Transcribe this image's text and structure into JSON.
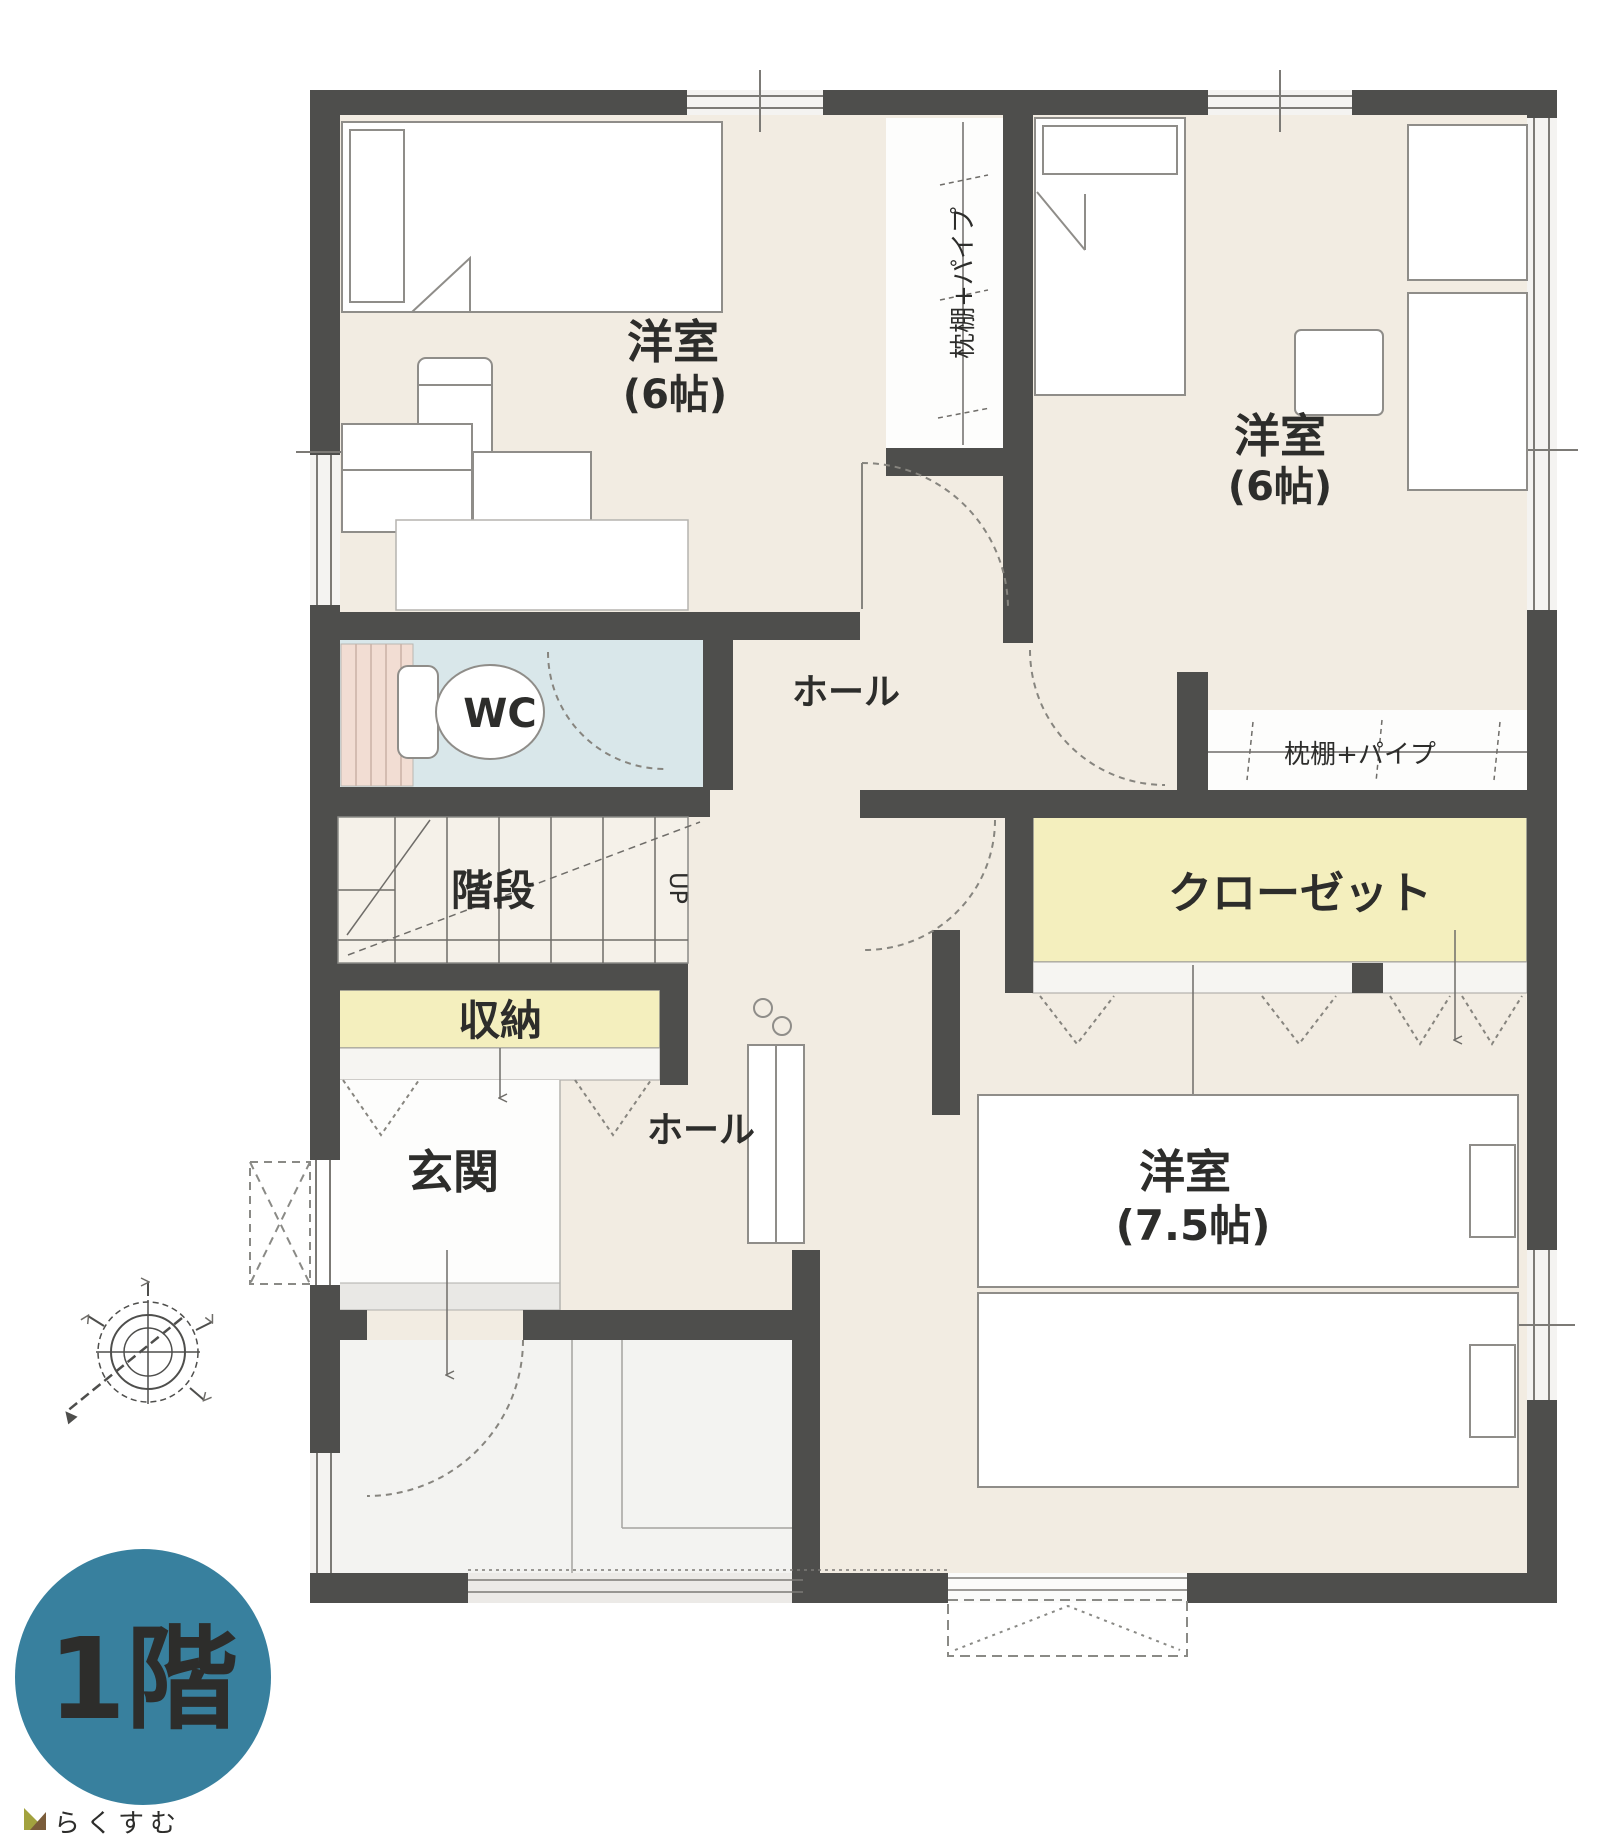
{
  "plan": {
    "floor_badge": "1階",
    "brand": "らくすむ",
    "labels": {
      "bedroom_nw": {
        "name": "洋室",
        "size": "(6帖)"
      },
      "bedroom_ne": {
        "name": "洋室",
        "size": "(6帖)"
      },
      "bedroom_s": {
        "name": "洋室",
        "size": "(7.5帖)"
      },
      "wc": "WC",
      "stairs": "階段",
      "stairs_direction": "UP",
      "storage": "収納",
      "entrance": "玄関",
      "hall_upper": "ホール",
      "hall_lower": "ホール",
      "closet": "クローゼット",
      "pillow_shelf_vertical": "枕棚+パイプ",
      "pillow_shelf_horizontal": "枕棚+パイプ"
    },
    "colors": {
      "wall": "#4e4e4c",
      "floor_beige": "#f2ece2",
      "floor_white": "#fdfdfc",
      "floor_gray": "#f3f3f1",
      "wc_blue": "#d9e7ea",
      "pink": "#f2ddd3",
      "yellow": "#f4efbe",
      "badge_teal": "#38809e",
      "line_gray": "#8a8a86",
      "text_dark": "#2d2d2b",
      "brand_brown": "#8f7348"
    }
  }
}
